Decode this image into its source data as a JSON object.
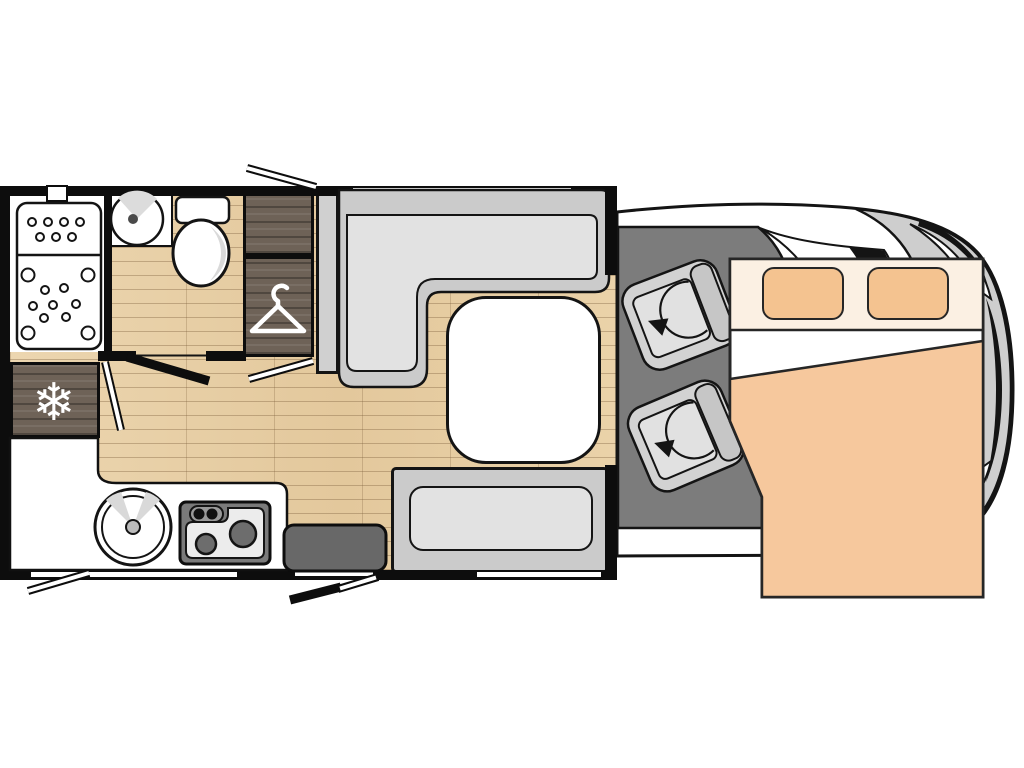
{
  "page": {
    "background": "#ffffff",
    "description": "Top-down floor plan of a coachbuilt motorhome, habitation area left, driver cab at right, drop-down bed over the cab"
  },
  "labels": {
    "plan": "Motorhome floor plan",
    "shower": "Shower cubicle",
    "shower_door": "Shower door (open)",
    "washbasin": "Washbasin",
    "toilet": "Toilet",
    "overhead_locker": "Overhead locker",
    "wardrobe": "Wardrobe",
    "wardrobe_door": "Washroom door (open)",
    "fridge": "Refrigerator",
    "kitchen": "Kitchen unit",
    "sink": "Round kitchen sink",
    "hob": "Two-burner hob",
    "bathroom_door": "Washroom partition door",
    "lounge_sofa": "L-shaped lounge sofa",
    "side_cabinet": "Tall side cabinet",
    "table": "Dinette table",
    "bench_seat": "Forward-facing travel bench",
    "entry_step": "Entrance step",
    "entry_door": "Entrance door (open)",
    "window_rear_top": "Window",
    "window_kitchen": "Window",
    "window_bench": "Window",
    "door_aperture": "Door aperture",
    "roof_vent": "Vent",
    "window_flap_top": "Top-hung window (open)",
    "window_flap_bottom": "Top-hung window (open)",
    "cab": "Driver cab",
    "cab_floor": "Cab floor",
    "windscreen": "Windscreen",
    "seat_front": "Swivel cab seat",
    "seat_rear": "Swivel cab seat",
    "swivel_arrow": "Seat swivel direction",
    "bed": "Drop-down double bed over cab",
    "bed_head": "Bed head section",
    "pillow_left": "Pillow",
    "pillow_right": "Pillow",
    "duvet": "Duvet",
    "vehicle_body": "Vehicle body outline",
    "floor": "Wood-effect floor",
    "hanger_icon": "clothes-hanger-icon",
    "snowflake_icon": "snowflake-icon"
  },
  "counts": {
    "swivel_seats": 2,
    "pillows": 2,
    "hob_burners": 2,
    "wall_windows": 3
  },
  "colors": {
    "outline": "#141414",
    "floor_wood": "#e7cda4",
    "dark_wood": "#6e6257",
    "sofa_gray": "#cbcbcb",
    "cushion_gray": "#e2e2e2",
    "cab_floor_gray": "#7c7c7c",
    "body_gray": "#cecece",
    "step_gray": "#686868",
    "bed_cream": "#fbf0e3",
    "bed_orange": "#f6c89d",
    "pillow_orange": "#f4c390"
  },
  "snowflake_glyph": "❄"
}
